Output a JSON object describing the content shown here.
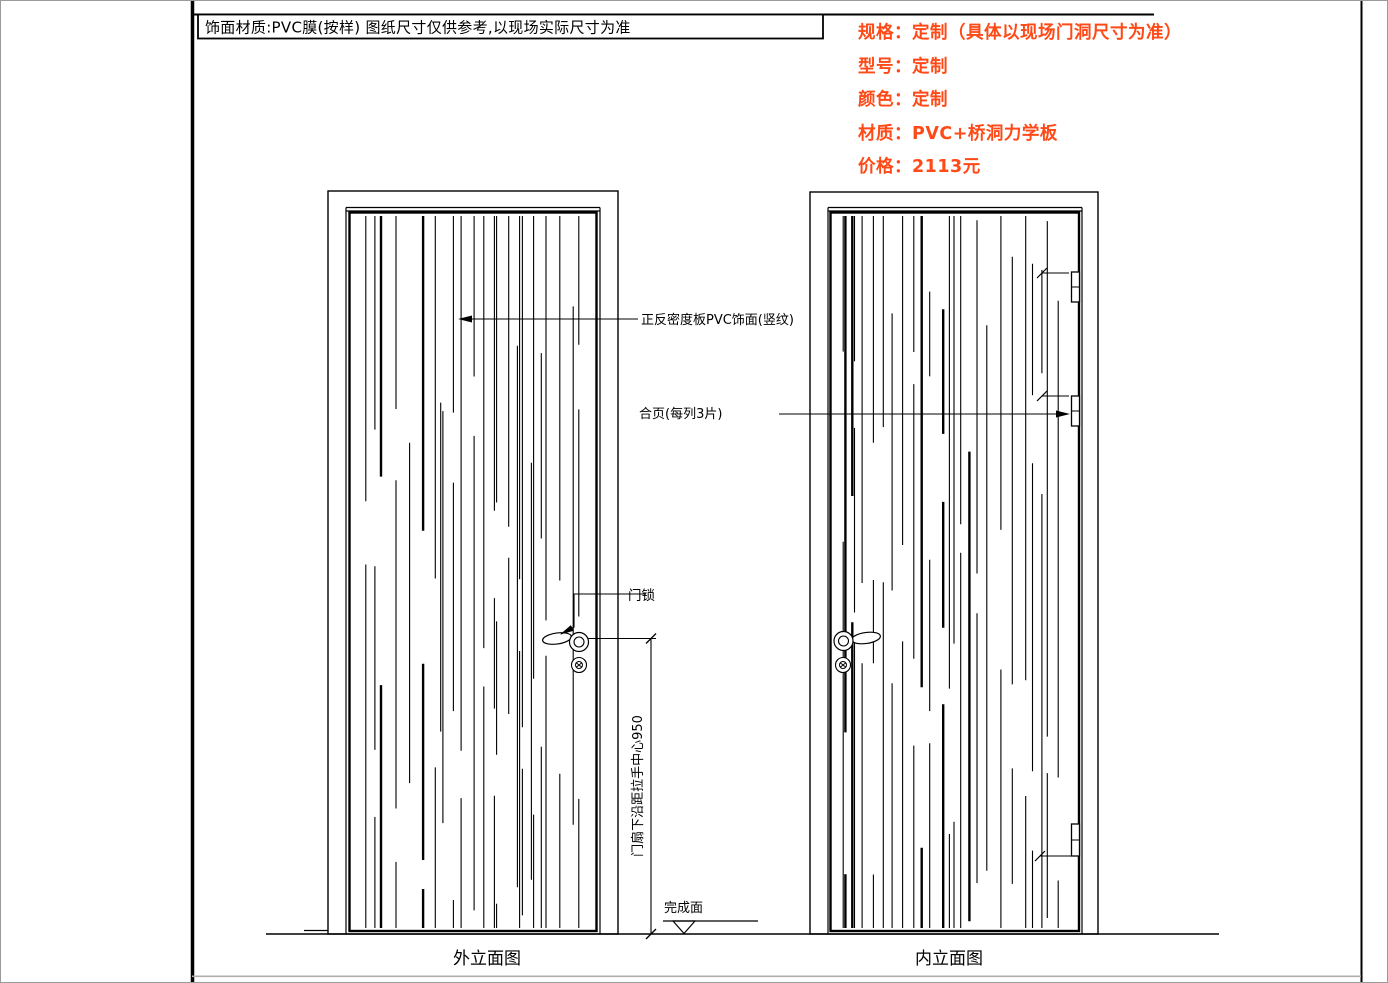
{
  "colors": {
    "accent": "#ff4a17",
    "ink": "#000000",
    "muted_rule": "#aeaeae"
  },
  "title_bar": {
    "text": "饰面材质:PVC膜(按样) 图纸尺寸仅供参考,以现场实际尺寸为准"
  },
  "specs": {
    "lines": [
      "规格：定制（具体以现场门洞尺寸为准）",
      "型号：定制",
      "颜色：定制",
      "材质：PVC+桥洞力学板",
      "价格：2113元"
    ]
  },
  "annotations": {
    "surface": "正反密度板PVC饰面(竖纹)",
    "hinge": "合页(每列3片)",
    "lock": "门锁",
    "handle_height_dim": "门扇下沿距拉手中心950",
    "finish_level": "完成面"
  },
  "views": {
    "left": {
      "caption": "外立面图"
    },
    "right": {
      "caption": "内立面图"
    }
  },
  "grain": {
    "areas": [
      {
        "name": "left-door",
        "x0": 352,
        "x1": 592,
        "y0": 215,
        "y1": 927,
        "seed": 20
      },
      {
        "name": "right-door",
        "x0": 833,
        "x1": 1073,
        "y0": 215,
        "y1": 927,
        "seed": 77
      }
    ]
  }
}
